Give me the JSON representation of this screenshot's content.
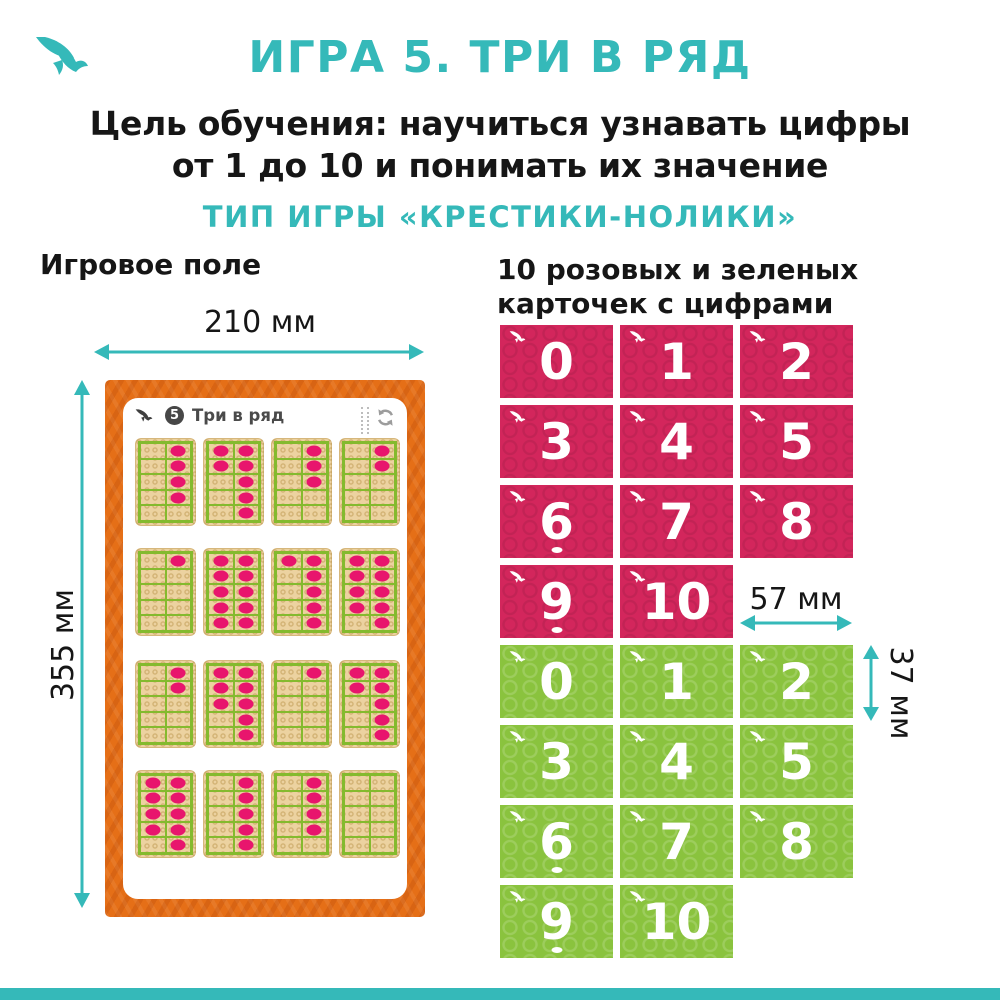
{
  "colors": {
    "teal": "#35b9b9",
    "ink": "#161616",
    "pink": "#d3265c",
    "green": "#8ac33e",
    "orange": "#e56f17",
    "tan": "#ecd2a0",
    "dot": "#e8156d",
    "grid_green": "#84ba2e",
    "panel_gray": "#4a4a4a",
    "icon_gray": "#9c9c9c"
  },
  "header": {
    "title": "ИГРА 5. ТРИ В РЯД",
    "goal_line1": "Цель обучения: научиться узнавать цифры",
    "goal_line2": "от 1 до 10 и понимать их значение",
    "game_type": "ТИП ИГРЫ «КРЕСТИКИ-НОЛИКИ»"
  },
  "board_section": {
    "heading": "Игровое поле",
    "width_label": "210 мм",
    "height_label": "355 мм",
    "panel_badge": "5",
    "panel_title": "Три в ряд",
    "dot_counts": [
      [
        4,
        7,
        3,
        2
      ],
      [
        1,
        10,
        6,
        9
      ],
      [
        2,
        8,
        1,
        7
      ],
      [
        9,
        5,
        4,
        0
      ]
    ]
  },
  "cards_section": {
    "heading_line1": "10 розовых и зеленых",
    "heading_line2": "карточек с цифрами",
    "card_width_label": "57 мм",
    "card_height_label": "37 мм",
    "pink_numbers": [
      "0",
      "1",
      "2",
      "3",
      "4",
      "5",
      "6",
      "7",
      "8",
      "9",
      "10"
    ],
    "green_numbers": [
      "0",
      "1",
      "2",
      "3",
      "4",
      "5",
      "6",
      "7",
      "8",
      "9",
      "10"
    ],
    "underlined_numbers": [
      "6",
      "9"
    ]
  }
}
